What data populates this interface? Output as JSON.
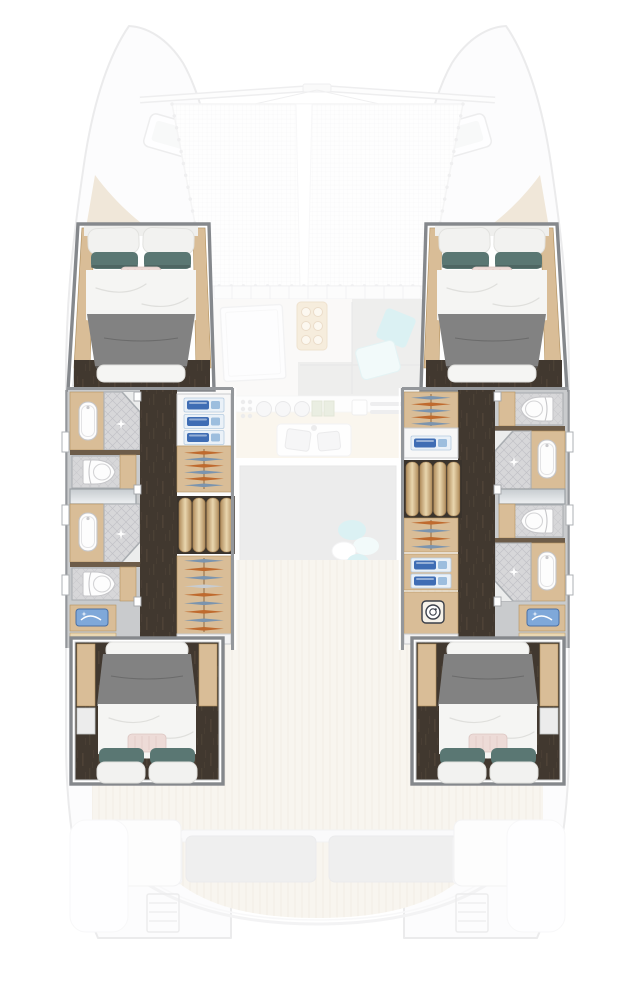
{
  "diagram": {
    "type": "yacht-floor-plan",
    "view": "top-down",
    "vessel": "sailing catamaran",
    "cabins": 4,
    "bathrooms": 4,
    "showers": 4,
    "toilets": 4,
    "berths": "double"
  },
  "labels": {
    "port_forward_cabin": "Port forward cabin with double berth",
    "starboard_forward_cabin": "Starboard forward cabin with double berth",
    "port_aft_cabin": "Port aft cabin with double berth",
    "starboard_aft_cabin": "Starboard aft cabin with double berth",
    "port_bathrooms": "Port hull bathrooms with showers and toilets",
    "starboard_bathrooms": "Starboard hull bathrooms with showers and toilets",
    "port_wardrobe": "Port hull wardrobe and shelving",
    "starboard_wardrobe": "Starboard hull wardrobe and laundry",
    "trampoline": "Bow trampoline net",
    "saloon": "Saloon seating area",
    "galley": "Galley with stove and double sink",
    "cockpit": "Aft cockpit with bench seating",
    "washer": "Washing machine",
    "stairs": "Companionway steps",
    "bow": "Bow deck hatches and anchor lockers",
    "stern": "Transom steps and swim platforms"
  },
  "colors": {
    "floor": "#41382f",
    "floorGrain": "#5d4e3e",
    "wood": "#d9bd97",
    "woodDark": "#b5935f",
    "woodLight": "#ead7b2",
    "wall": "#94979b",
    "frame": "#85888c",
    "bedGray": "#828282",
    "bedGrayDark": "#6b6b6b",
    "duvet": "#f5f5f3",
    "duvetLine": "#dfdfdc",
    "pillowWhite": "#f2f2f0",
    "pillowTeal": "#5a7773",
    "pillowTealDark": "#48605d",
    "pillowBlush": "#eddbd7",
    "tile": "#d7d7d9",
    "tileLine": "#bfbfc4",
    "bathWall": "#c9cbcd",
    "porcelain": "#fdfdfd",
    "porcelainEdge": "#c6c6c9",
    "towelBlue": "#3f6db4",
    "towelPale": "#9dbede",
    "shelfBg": "#eaf1f8",
    "hangerOrange": "#bf6a2e",
    "hangerBlue": "#7b94ae",
    "hangerLight": "#c8ccd0",
    "glassA": "#c7ccd0",
    "glassB": "#eef0f2",
    "washerDark": "#3a3f49",
    "basinBlue": "#7fa8d9",
    "basinBlueDark": "#4a6fa5",
    "fadedFill": "#f8f8f9",
    "fadedStroke": "#cfcfd2",
    "sofaGray": "#d6d6d5",
    "aqua": "#a9dee2",
    "aquaPale": "#dff3f4",
    "teak": "#efe8d9",
    "teakLine": "#ddd0ba",
    "tan": "#dcc6a4",
    "rug": "#d2d2d1",
    "net": "#e4e4e6",
    "benchCushion": "#dadada",
    "matTan": "#edddc2",
    "matDot": "#c49e73"
  }
}
